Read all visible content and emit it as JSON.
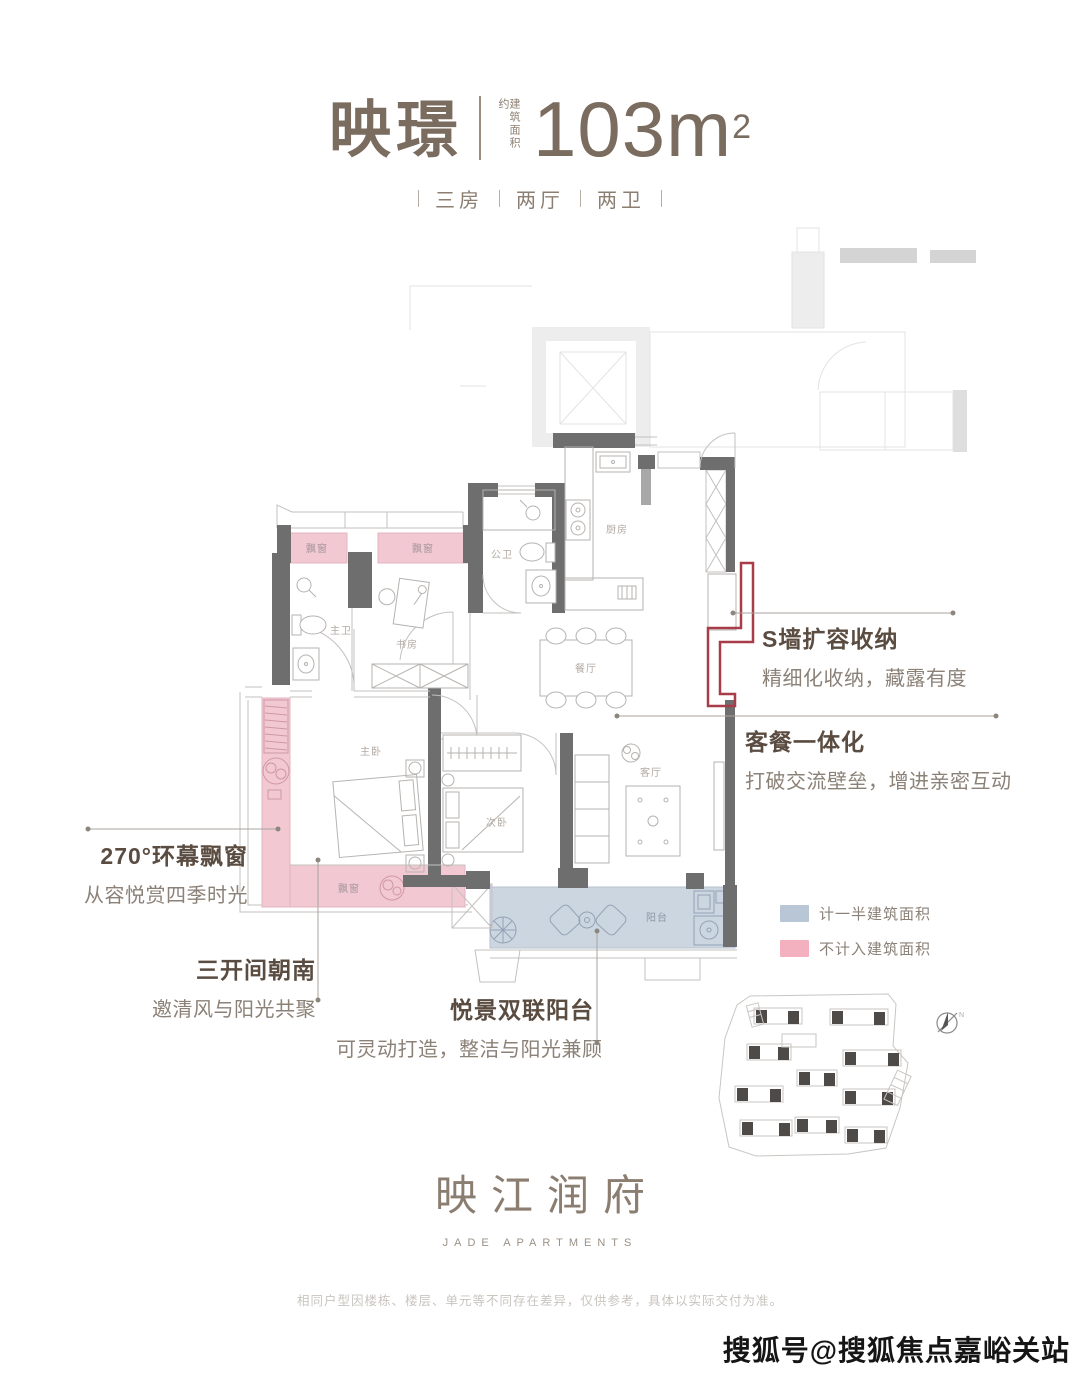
{
  "header": {
    "name": "映璟",
    "area_label": "建筑面积约",
    "area_value": "103m",
    "area_sup": "2",
    "layout_items": [
      "三房",
      "两厅",
      "两卫"
    ]
  },
  "callouts": {
    "s_wall": {
      "title": "S墙扩容收纳",
      "desc": "精细化收纳，藏露有度"
    },
    "dining": {
      "title": "客餐一体化",
      "desc": "打破交流壁垒，增进亲密互动"
    },
    "bay": {
      "title": "270°环幕飘窗",
      "desc": "从容悦赏四季时光"
    },
    "south": {
      "title": "三开间朝南",
      "desc": "邀清风与阳光共聚"
    },
    "balcony": {
      "title": "悦景双联阳台",
      "desc": "可灵动打造，整洁与阳光兼顾"
    }
  },
  "legend": {
    "half_area": {
      "label": "计一半建筑面积",
      "color": "#b9c6d5"
    },
    "no_area": {
      "label": "不计入建筑面积",
      "color": "#f3b0bf"
    }
  },
  "plan": {
    "rooms": {
      "bay_window": "飘窗",
      "master_bath": "主卫",
      "study": "书房",
      "public_bath": "公卫",
      "kitchen": "厨房",
      "dining_room": "餐厅",
      "master_bedroom": "主卧",
      "second_bedroom": "次卧",
      "living_room": "客厅",
      "balcony": "阳台"
    },
    "colors": {
      "wall": "#6e6e6e",
      "not_counted_pink": "#f2c9d2",
      "half_counted_blue": "#ccd6e1",
      "s_wall_highlight_red": "#a83c49"
    }
  },
  "compass": {
    "label": "N"
  },
  "brand": {
    "name_cn": "映江润府",
    "name_en": "JADE APARTMENTS"
  },
  "footer": {
    "disclaimer": "相同户型因楼栋、楼层、单元等不同存在差异，仅供参考，具体以实际交付为准。"
  },
  "watermark": "搜狐号@搜狐焦点嘉峪关站"
}
